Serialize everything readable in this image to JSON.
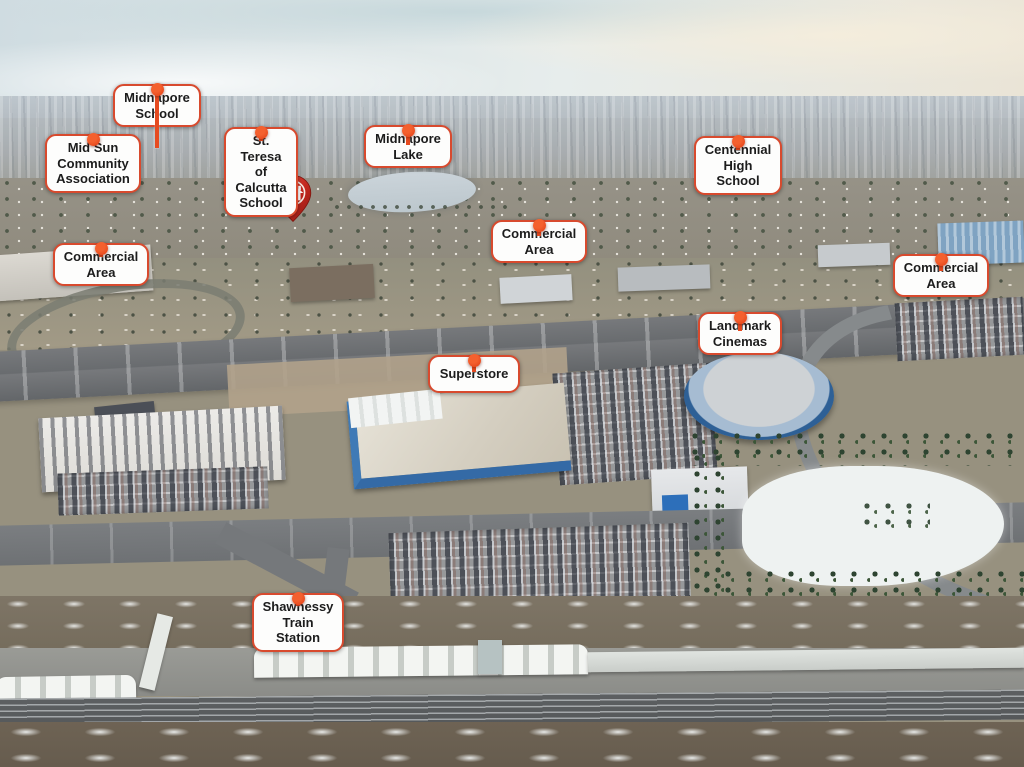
{
  "image": {
    "type": "annotated-aerial-photograph",
    "description": "Winter aerial photo of a suburban district with highway, big-box stores, lake, schools and a train station, annotated with location callouts and a red home pin"
  },
  "palette": {
    "label_border": "#d84a2e",
    "label_background": "#fdfdfc",
    "label_text": "#1c1c1c",
    "leader_line": "#e64b20",
    "location_dot": "#e8481e",
    "home_pin_red": "#c2271e",
    "sky": "#dde7ea",
    "highway_gray": "#6a6d70",
    "snow_white": "#eef2f1",
    "winter_ground": "#948e83"
  },
  "markers": [
    {
      "name": "midnapore-school",
      "label": "Midnapore\nSchool"
    },
    {
      "name": "mid-sun-community-association",
      "label": "Mid Sun\nCommunity\nAssociation"
    },
    {
      "name": "st-teresa-of-calcutta-school",
      "label": "St. Teresa of\nCalcutta School"
    },
    {
      "name": "midnapore-lake",
      "label": "Midnapore\nLake"
    },
    {
      "name": "centennial-high-school",
      "label": "Centennial\nHigh School"
    },
    {
      "name": "commercial-area-west",
      "label": "Commercial\nArea"
    },
    {
      "name": "commercial-area-central",
      "label": "Commercial\nArea"
    },
    {
      "name": "commercial-area-east",
      "label": "Commercial\nArea"
    },
    {
      "name": "landmark-cinemas",
      "label": "Landmark\nCinemas"
    },
    {
      "name": "superstore",
      "label": "Superstore"
    },
    {
      "name": "shawnessy-train-station",
      "label": "Shawnessy\nTrain Station"
    }
  ],
  "home_pin": {
    "name": "subject-property-pin",
    "icon": "house-icon"
  }
}
